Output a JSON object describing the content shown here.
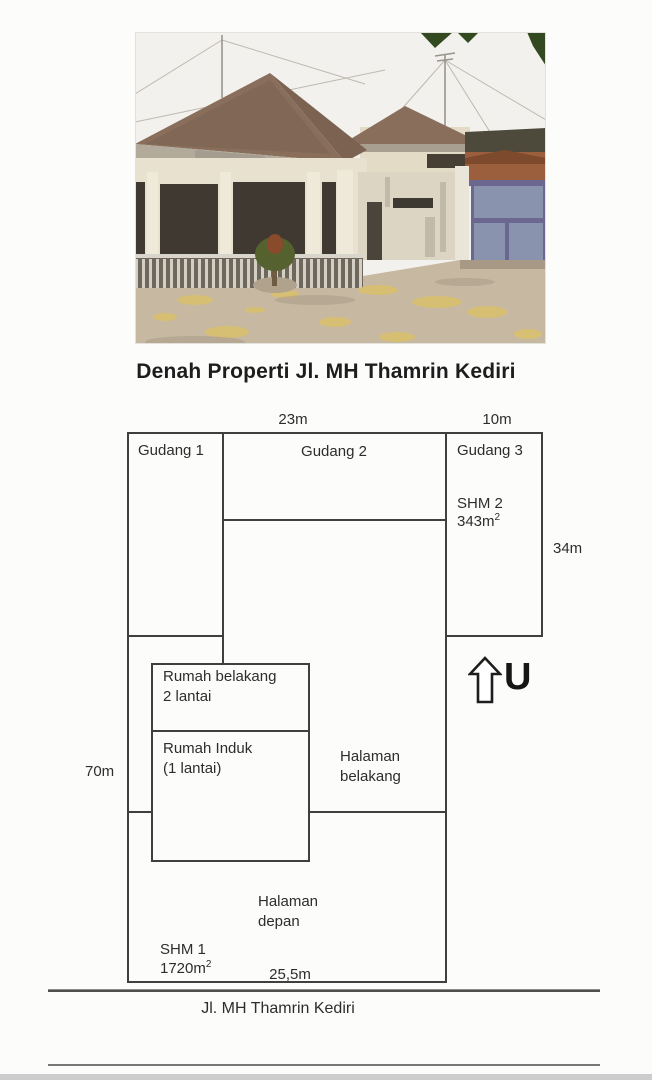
{
  "title": "Denah Properti Jl. MH Thamrin Kediri",
  "plan": {
    "dimensions": {
      "top_width": "23m",
      "top_right_width": "10m",
      "right_height": "34m",
      "left_height": "70m",
      "front_width": "25,5m"
    },
    "rooms": {
      "gudang1": "Gudang 1",
      "gudang2": "Gudang 2",
      "gudang3": "Gudang 3",
      "shm2_name": "SHM 2",
      "shm2_area": "343m",
      "shm2_area_sup": "2",
      "rumah_belakang_line1": "Rumah belakang",
      "rumah_belakang_line2": "2 lantai",
      "rumah_induk_line1": "Rumah Induk",
      "rumah_induk_line2": "(1 lantai)",
      "halaman_belakang_line1": "Halaman",
      "halaman_belakang_line2": "belakang",
      "halaman_depan_line1": "Halaman",
      "halaman_depan_line2": "depan",
      "shm1_name": "SHM 1",
      "shm1_area": "1720m",
      "shm1_area_sup": "2"
    },
    "north_label": "U",
    "street": "Jl. MH Thamrin Kediri"
  },
  "colors": {
    "plan_line": "#3f3f3f",
    "text": "#2d2d2d",
    "roof_brown": "#8a6e5c",
    "gate_blue": "#8a93ae",
    "ground_tan": "#c7b8a2"
  }
}
